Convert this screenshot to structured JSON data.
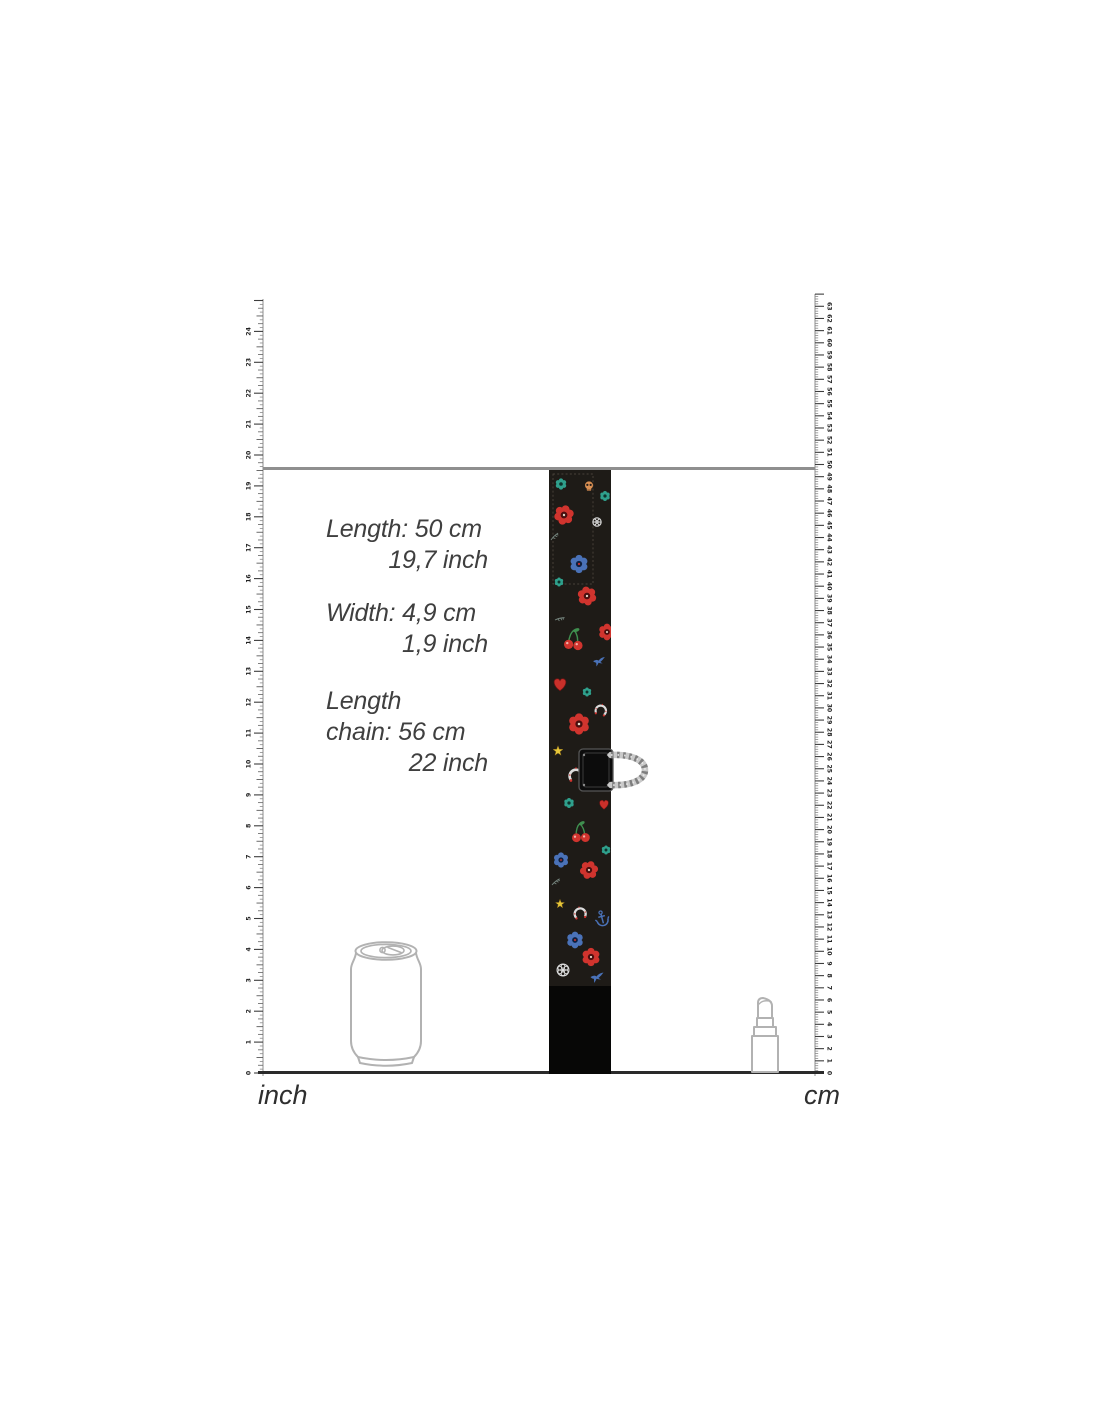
{
  "specs": [
    {
      "lines": [
        {
          "text": "Length: 50 cm"
        },
        {
          "text": "19,7 inch"
        }
      ]
    },
    {
      "lines": [
        {
          "text": "Width: 4,9 cm"
        },
        {
          "text": "1,9 inch"
        }
      ]
    },
    {
      "lines": [
        {
          "text": "Length"
        },
        {
          "text": "chain: 56 cm"
        },
        {
          "text": "22 inch"
        }
      ]
    }
  ],
  "ruler_labels": {
    "left": "inch",
    "right": "cm"
  },
  "rulers": {
    "baseline_y": 1073,
    "left": {
      "group": "left-ruler-g",
      "side": "left",
      "x": 263,
      "top_y": 299,
      "px_per_unit": 30.9,
      "max_units": 25,
      "subdivisions": 8,
      "numbers_from": 0,
      "numbers_to": 24
    },
    "right": {
      "group": "right-ruler-g",
      "side": "right",
      "x": 815,
      "top_y": 294,
      "px_per_unit": 12.17,
      "max_units": 64,
      "subdivisions": 5,
      "numbers_from": 0,
      "numbers_to": 63
    }
  },
  "colors": {
    "topline": "#8f8f8f",
    "baseline": "#2a2a2a",
    "text": "#3f3f3f",
    "outline": "#b2b2b2",
    "strap_background": "#1e1b17",
    "flower_red": "#d0342e",
    "flower_blue": "#4a72b8",
    "star_yellow": "#e6c73a",
    "ring_chrome": "#c9c9c9"
  },
  "icons": {
    "reference_left": "soda-can",
    "reference_right": "lipstick",
    "hardware": "d-ring"
  }
}
